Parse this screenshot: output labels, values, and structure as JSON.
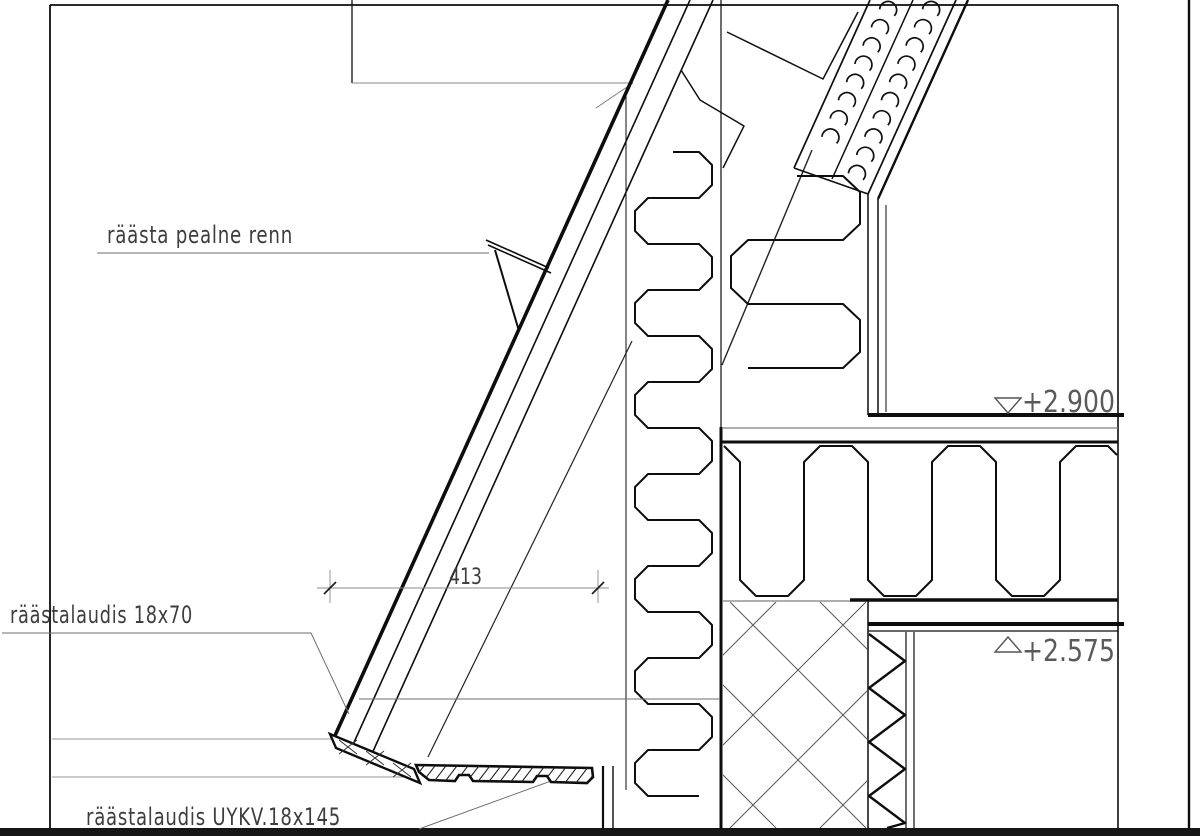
{
  "drawing": {
    "labels": {
      "gutter": "räästa pealne renn",
      "fascia_small": "räästalaudis 18x70",
      "fascia_profiled": "räästalaudis UYKV.18x145"
    },
    "dimension": {
      "value": "413"
    },
    "levels": {
      "upper": "+2.900",
      "lower": "+2.575"
    },
    "colors": {
      "line": "#0d0d0d",
      "leader": "#7a7a7a",
      "text": "#3d3d3d",
      "level_text": "#5a5a5a",
      "background": "#ffffff"
    }
  }
}
